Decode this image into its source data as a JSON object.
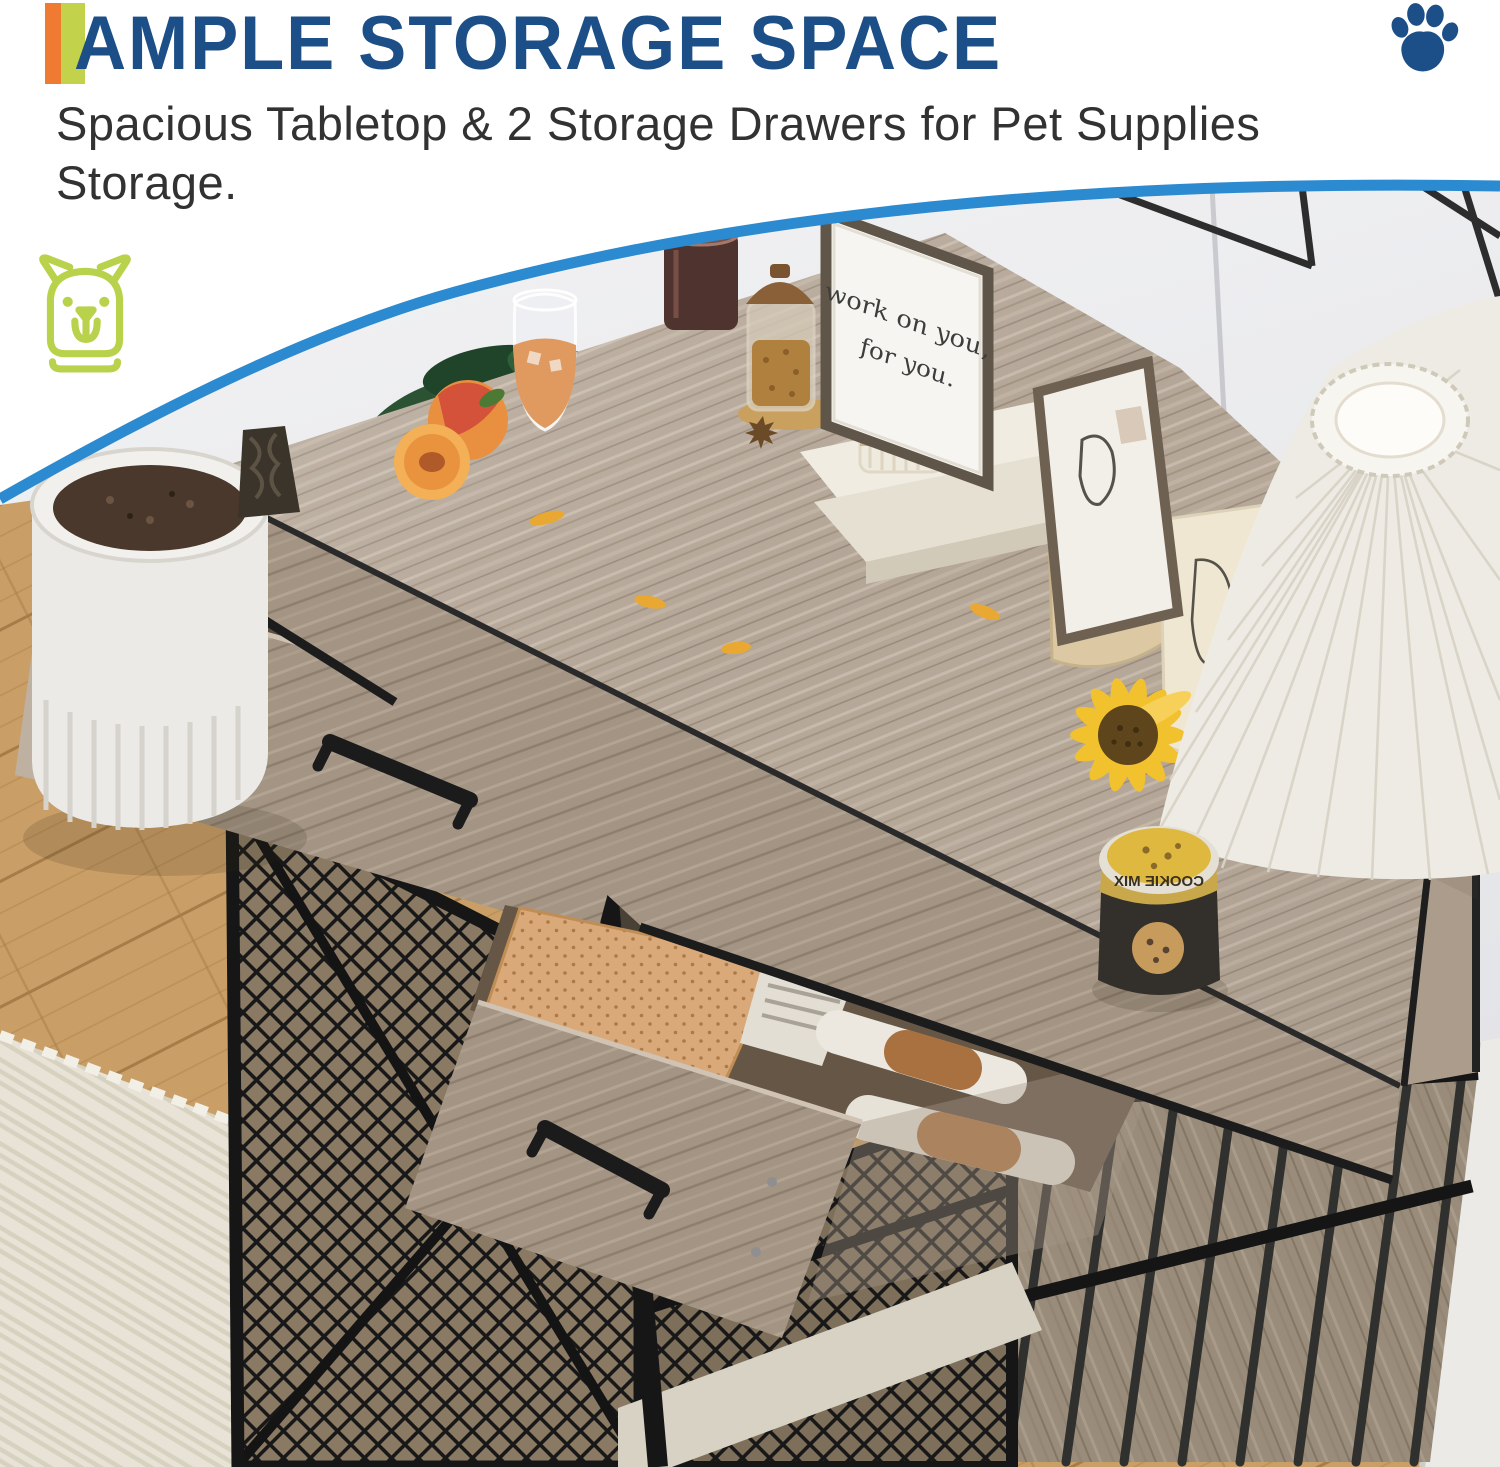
{
  "header": {
    "title": "AMPLE STORAGE SPACE",
    "subtitle_line1": "Spacious Tabletop & 2 Storage Drawers for Pet Supplies",
    "subtitle_line2": "Storage.",
    "title_color": "#1c4f87",
    "accent_orange": "#ef7a31",
    "accent_green": "#c3d24b"
  },
  "icons": {
    "paw_color": "#1c4f87",
    "dog_outline_color": "#b9d24b"
  },
  "photo": {
    "divider_color": "#2b8ad0",
    "sign_line1": "work on you,",
    "sign_line2": "for you.",
    "cookie_jar_label": "COOKIE MIX",
    "can_label": "XIM",
    "alt": "Farmhouse dog crate side table with gray wood tabletop, two open storage drawers with pet supplies, black metal mesh doors and bars, styled with pleated lamp, sunflower, paper bags, framed quote, books, candle, treat jars, potted plant, on oak floor with white rug"
  }
}
